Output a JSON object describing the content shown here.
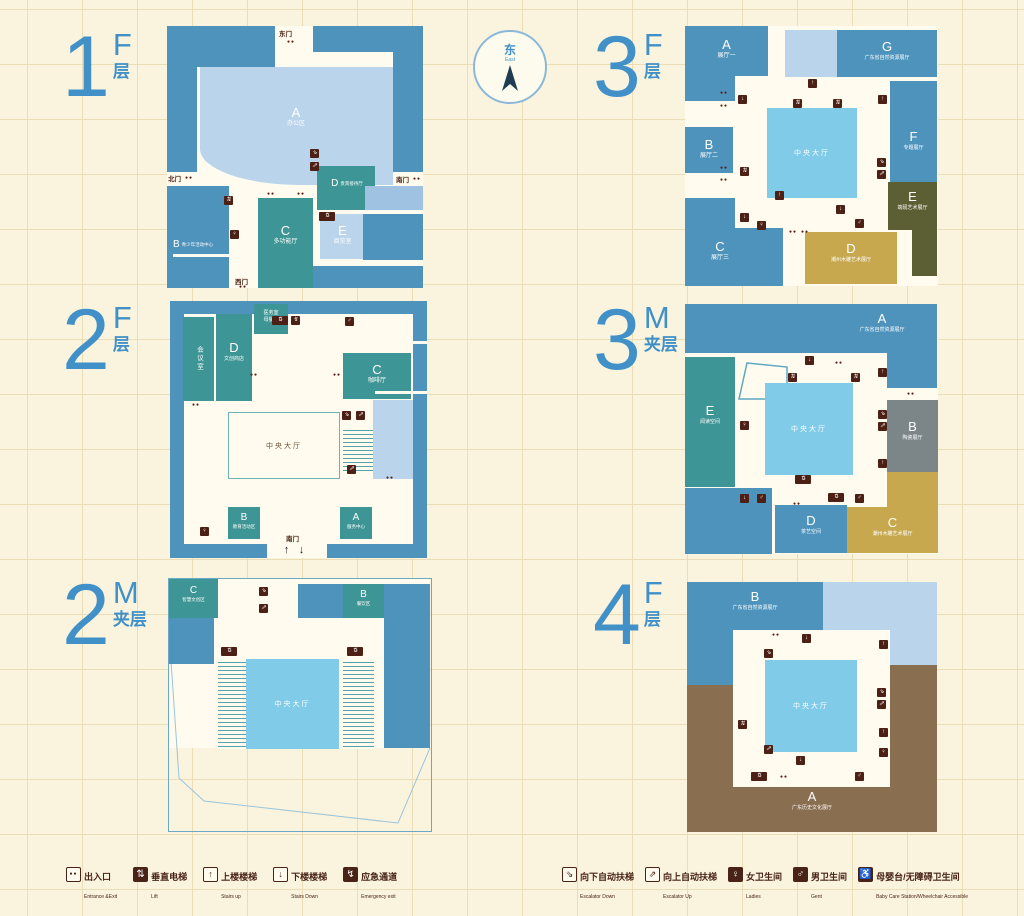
{
  "compass": {
    "cn": "东",
    "en": "East"
  },
  "floors": {
    "f1": {
      "num": "1",
      "unit": "F",
      "unit_cn": "层",
      "rooms": {
        "a": {
          "k": "A",
          "label": "办公区"
        },
        "b": {
          "k": "B",
          "label": "青少年活动中心"
        },
        "c": {
          "k": "C",
          "label": "多功能厅"
        },
        "d": {
          "k": "D",
          "label": "贵宾接待厅"
        },
        "e": {
          "k": "E",
          "label": "阅览室"
        }
      },
      "doors": {
        "east": "东门",
        "north": "北门",
        "south": "南门",
        "west": "西门"
      }
    },
    "f2": {
      "num": "2",
      "unit": "F",
      "unit_cn": "层",
      "rooms": {
        "meeting": {
          "label": "会议室"
        },
        "d": {
          "k": "D",
          "label": "文创商店"
        },
        "clinic": {
          "label": "医务室"
        },
        "nursing": {
          "label": "母婴室"
        },
        "c": {
          "k": "C",
          "label": "咖啡厅"
        },
        "b": {
          "k": "B",
          "label": "教育活动区"
        },
        "a": {
          "k": "A",
          "label": "服务中心"
        },
        "hall": {
          "label": "中央大厅"
        }
      },
      "doors": {
        "south": "南门"
      }
    },
    "f2m": {
      "num": "2",
      "unit": "M",
      "unit_cn": "夹层",
      "rooms": {
        "c": {
          "k": "C",
          "label": "智慧文创区"
        },
        "b": {
          "k": "B",
          "label": "餐饮区"
        },
        "hall": {
          "label": "中央大厅"
        }
      }
    },
    "f3": {
      "num": "3",
      "unit": "F",
      "unit_cn": "层",
      "rooms": {
        "a": {
          "k": "A",
          "label": "展厅一"
        },
        "b": {
          "k": "B",
          "label": "展厅二"
        },
        "c": {
          "k": "C",
          "label": "展厅三"
        },
        "d": {
          "k": "D",
          "label": "潮州木雕艺术展厅"
        },
        "e": {
          "k": "E",
          "label": "端砚艺术展厅"
        },
        "f": {
          "k": "F",
          "label": "专题展厅"
        },
        "g": {
          "k": "G",
          "label": "广东省自然资源展厅"
        },
        "hall": {
          "label": "中央大厅"
        }
      }
    },
    "f3m": {
      "num": "3",
      "unit": "M",
      "unit_cn": "夹层",
      "rooms": {
        "a": {
          "k": "A",
          "label": "广东省自然资源展厅"
        },
        "b": {
          "k": "B",
          "label": "陶瓷展厅"
        },
        "c": {
          "k": "C",
          "label": "潮州木雕艺术展厅"
        },
        "d": {
          "k": "D",
          "label": "茶艺空间"
        },
        "e": {
          "k": "E",
          "label": "阅读空间"
        },
        "hall": {
          "label": "中央大厅"
        }
      }
    },
    "f4": {
      "num": "4",
      "unit": "F",
      "unit_cn": "层",
      "rooms": {
        "a": {
          "k": "A",
          "label": "广东历史文化展厅"
        },
        "b": {
          "k": "B",
          "label": "广东省自然资源展厅"
        },
        "hall": {
          "label": "中央大厅"
        }
      }
    }
  },
  "legend": [
    {
      "cn": "出入口",
      "en": "Entrance &Exit",
      "icon": "entrance"
    },
    {
      "cn": "垂直电梯",
      "en": "Lift",
      "icon": "lift"
    },
    {
      "cn": "上楼楼梯",
      "en": "Stairs up",
      "icon": "stairs_up"
    },
    {
      "cn": "下楼楼梯",
      "en": "Stairs Down",
      "icon": "stairs_down"
    },
    {
      "cn": "应急通道",
      "en": "Emergency exit",
      "icon": "emergency"
    },
    {
      "cn": "向下自动扶梯",
      "en": "Escalator Down",
      "icon": "esc_down"
    },
    {
      "cn": "向上自动扶梯",
      "en": "Escalator Up",
      "icon": "esc_up"
    },
    {
      "cn": "女卫生间",
      "en": "Ladies",
      "icon": "ladies"
    },
    {
      "cn": "男卫生间",
      "en": "Gent",
      "icon": "gents"
    },
    {
      "cn": "母婴台/无障碍卫生间",
      "en": "Baby Care Station/Wheelchair Accessible",
      "icon": "baby"
    }
  ],
  "icons": {
    "entrance": "●●",
    "lift": "⇅",
    "stairs_up": "↑",
    "stairs_down": "↓",
    "emergency": "↯",
    "esc_down": "⇘",
    "esc_up": "⇗",
    "ladies": "♀",
    "gents": "♂",
    "baby": "♿",
    "arrow_up": "↑",
    "arrow_down": "↓",
    "door_dots": "●●"
  }
}
